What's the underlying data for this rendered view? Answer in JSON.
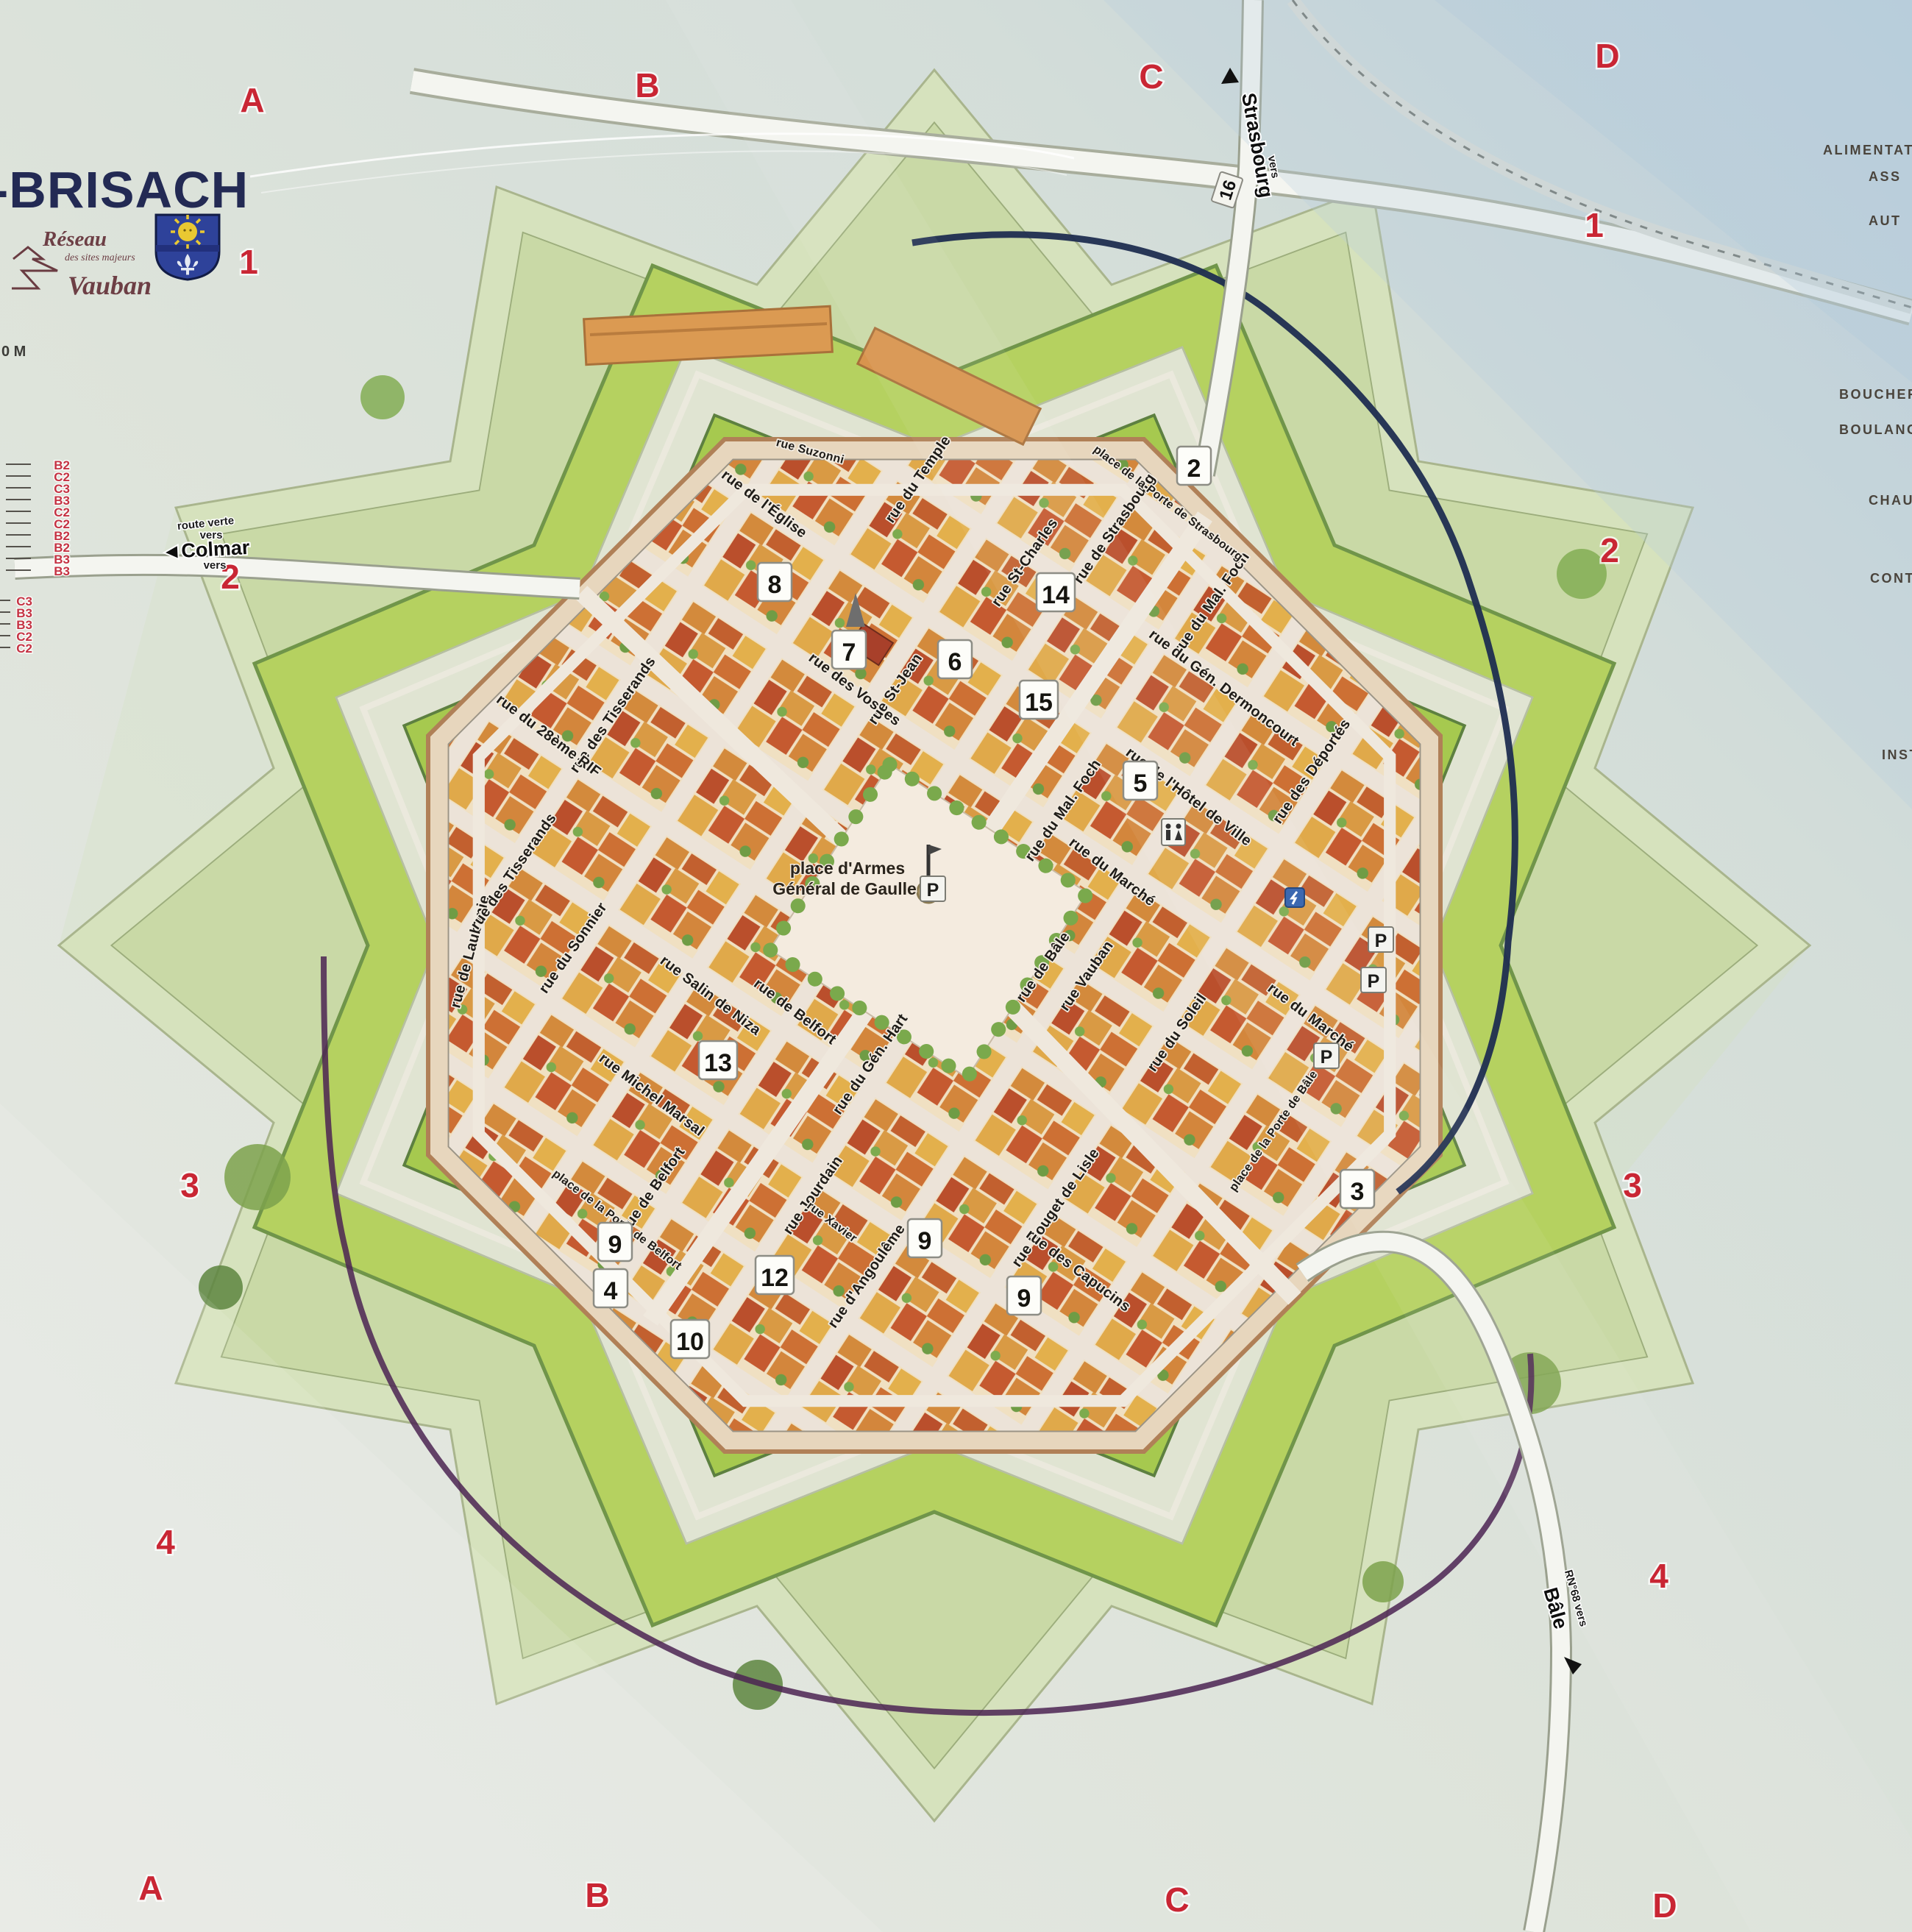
{
  "panel": {
    "title": "-BRISACH",
    "scale_label": "0 M",
    "logo": {
      "line1": "Réseau",
      "line2": "des sites majeurs",
      "line3": "Vauban"
    },
    "grid": {
      "top": [
        "A",
        "B",
        "C",
        "D"
      ],
      "bottom": [
        "A",
        "B",
        "C",
        "D"
      ],
      "left": [
        "1",
        "2",
        "3",
        "4"
      ],
      "right": [
        "1",
        "2",
        "3",
        "4"
      ]
    },
    "left_refs": [
      "B2",
      "C2",
      "C3",
      "B3",
      "C2",
      "C2",
      "B2",
      "B2",
      "B3",
      "B3",
      "C3",
      "B3",
      "B3",
      "C2",
      "C2"
    ],
    "right_legend": [
      "ALIMENTATION G",
      "ASS",
      "AUT",
      "BOUCHERIE-C",
      "BOULANGERIE",
      "CHAUFFA",
      "CONTRÔ",
      "INST"
    ]
  },
  "roads": {
    "colmar": {
      "line1": "route verte",
      "line2": "vers",
      "name": "◄Colmar",
      "line3": "vers"
    },
    "strasbourg": {
      "prefix": "vers",
      "name": "Strasbourg",
      "shield": "16"
    },
    "bale": {
      "prefix": "RN°68 vers",
      "name": "Bâle"
    }
  },
  "square": {
    "line1": "place d'Armes",
    "line2": "Général de Gaulle"
  },
  "streets": [
    "rue de l'Église",
    "rue Suzonni",
    "rue du Temple",
    "rue des Vosges",
    "rue St-Jean",
    "rue St-Charles",
    "rue du Mal. Foch",
    "rue du Mal. Foch",
    "rue du Gén. Dermoncourt",
    "rue Vauban",
    "rue de l'Hôtel de Ville",
    "rue du Marché",
    "rue du Marché",
    "rue du Soleil",
    "rue de Bâle",
    "rue d'Angoulême",
    "rue Jourdain",
    "rue Rouget de Lisle",
    "rue des Capucins",
    "rue de Belfort",
    "rue de Belfort",
    "place de la Porte de Belfort",
    "rue Michel Marsal",
    "rue Salin de Niza",
    "rue du Sonnier",
    "rue de Laubanie",
    "rue des Tisserands",
    "rue des Tisserands",
    "rue du 28ème RIF",
    "rue du Gén. Hart",
    "rue de Strasbourg",
    "place de la Porte de Strasbourg",
    "place de la Porte de Bâle",
    "rue des Déportés",
    "rue Xavier"
  ],
  "markers": [
    "2",
    "3",
    "4",
    "5",
    "6",
    "7",
    "8",
    "9",
    "9",
    "9",
    "10",
    "12",
    "13",
    "14",
    "15"
  ],
  "parking": "P",
  "colors": {
    "glacis": "#d6e2bd",
    "rampart_green": "#b5d160",
    "wall_tan": "#e7d6bd",
    "moat_navy": "#1f2d50",
    "path_purple": "#4b2352",
    "grid_red": "#c92634",
    "title_navy": "#232a54"
  }
}
